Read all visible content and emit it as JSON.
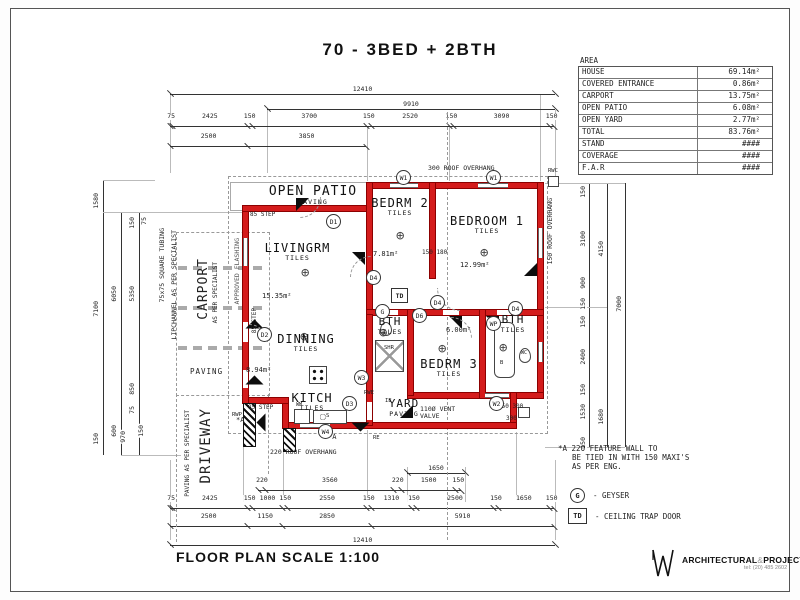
{
  "title": "70 - 3BED + 2BTH",
  "footer": {
    "scale": "FLOOR PLAN  SCALE 1:100"
  },
  "logo": {
    "brand_bold": "ARCHITECTURAL",
    "amp": "&",
    "brand_bold2": "PROJECT",
    "brand_light": "SERVICES",
    "tel": "tel: (20) 485 2602"
  },
  "area_table": {
    "header": "AREA",
    "rows": [
      [
        "HOUSE",
        "69.14m²"
      ],
      [
        "COVERED ENTRANCE",
        "0.86m²"
      ],
      [
        "CARPORT",
        "13.75m²"
      ],
      [
        "OPEN PATIO",
        "6.08m²"
      ],
      [
        "OPEN YARD",
        "2.77m²"
      ],
      [
        "TOTAL",
        "83.76m²"
      ],
      [
        "STAND",
        "####"
      ],
      [
        "COVERAGE",
        "####"
      ],
      [
        "F.A.R",
        "####"
      ]
    ]
  },
  "note": {
    "l1": "*A 220 FEATURE WALL TO",
    "l2": "BE TIED IN WITH 150 MAXI'S",
    "l3": "AS PER ENG."
  },
  "legend": {
    "g": "G",
    "g_text": "- GEYSER",
    "td": "TD",
    "td_text": "- CEILING TRAP DOOR"
  },
  "rooms": {
    "patio": {
      "name": "OPEN PATIO",
      "floor": "PAVING"
    },
    "livingrm": {
      "name": "LIVINGRM",
      "floor": "TILES",
      "area": "15.35m²"
    },
    "bedrm2": {
      "name": "BEDRM 2",
      "floor": "TILES",
      "area": "7.81m²"
    },
    "bedroom1": {
      "name": "BEDROOM 1",
      "floor": "TILES",
      "area": "12.99m²"
    },
    "dinning": {
      "name": "DINNING",
      "floor": "TILES",
      "area": "8.94m²"
    },
    "kitch": {
      "name": "KITCH",
      "floor": "TILES"
    },
    "bth1": {
      "name": "BTH",
      "floor": "TILES"
    },
    "bedrm3": {
      "name": "BEDRM 3",
      "floor": "TILES",
      "area": "6.00m²"
    },
    "bth2": {
      "name": "BTH",
      "floor": "TILES"
    },
    "yard": {
      "name": "YARD",
      "floor": "PAVING"
    },
    "carport": {
      "name": "CARPORT",
      "sub": "AS PER SPECIALIST",
      "floor": "PAVING"
    },
    "driveway": {
      "name": "DRIVEWAY",
      "sub": "PAVING AS PER SPECIALIST"
    }
  },
  "ann": {
    "roof_top": "300 ROOF OVERHANG",
    "roof_right": "150 ROOF OVERHANG",
    "roof_bottom": "220 ROOF OVERHANG",
    "rwc": "RWC",
    "step": "85 STEP",
    "vent1": "110Ø VENT",
    "vent2": "VALVE",
    "tubing": "75x75 SQUARE TUBING",
    "lip": "LIPCHANNEL AS PER SPECIALIST",
    "flashing": "APPROVED FLASHING",
    "d150_180": "150  180",
    "d150_300": "150 300",
    "d300": "300",
    "star_a": "*A",
    "shr": "SHR",
    "wm": "WM",
    "b": "B",
    "s": "S",
    "re": "RE",
    "ie": "IE",
    "rwe": "RWE",
    "rwp": "RWP",
    "wc": "WC"
  },
  "sym": {
    "w1": "W1",
    "w2": "W2",
    "w3": "W3",
    "w4": "W4",
    "d1": "D1",
    "d2": "D2",
    "d3": "D3",
    "d4": "D4",
    "d6": "D6",
    "g": "G",
    "td": "TD",
    "wp": "WP"
  },
  "icons": {
    "light": "⊕"
  },
  "dims": {
    "top_12410": "12410",
    "top_9910": "9910",
    "top_chain": [
      "75",
      "2425",
      "150",
      "3700",
      "150",
      "2520",
      "150",
      "3090",
      "150"
    ],
    "top_chain2": [
      "2500",
      "3850"
    ],
    "bot_1650": "1650",
    "bot_chain1": [
      "220",
      "3560",
      "220",
      "1500",
      "150"
    ],
    "bot_chain2": [
      "75",
      "2425",
      "150",
      "1000",
      "150",
      "2550",
      "150",
      "1310",
      "150",
      "2500",
      "150",
      "1650",
      "150"
    ],
    "bot_chain3": [
      "2500",
      "1150",
      "2850",
      "5910"
    ],
    "bot_12410": "12410",
    "left": {
      "d1580": "1580",
      "d7100": "7100",
      "d6050": "6050",
      "d5350": "5350",
      "d150a": "150",
      "d75a": "75",
      "d850": "850",
      "d75b": "75",
      "d970": "970",
      "d600": "600",
      "d150b": "150",
      "d150c": "150"
    },
    "right": {
      "r150a": "150",
      "r3100": "3100",
      "r900": "900",
      "r150b": "150",
      "r150c": "150",
      "r2400": "2400",
      "r150d": "150",
      "r1530": "1530",
      "r150e": "150",
      "r4150": "4150",
      "r1680": "1680",
      "r7000": "7000"
    }
  }
}
